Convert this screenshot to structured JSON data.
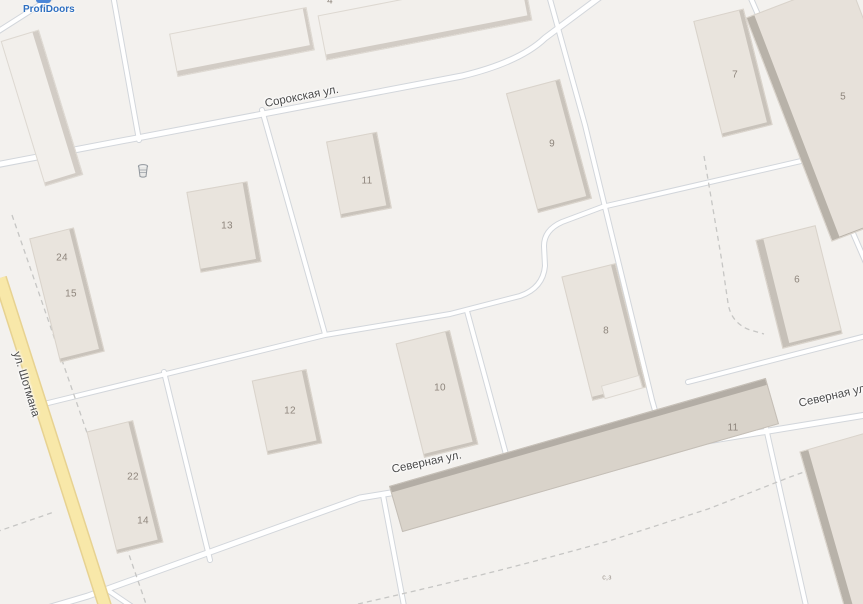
{
  "poi": {
    "profidoors_label": "ProfiDoors",
    "profidoors_color": "#2e6fc0",
    "trash_icon": "trash-bin-icon"
  },
  "streets": {
    "sorokskaya": "Сорокская ул.",
    "shotmana": "ул. Шотмана",
    "severnaya": "Северная ул.",
    "severnaya_east": "Северная ул."
  },
  "building_numbers": {
    "b13": "13",
    "b24": "24",
    "b15": "15",
    "b11_top": "11",
    "b9": "9",
    "b7": "7",
    "b5": "5",
    "b8": "8",
    "b6": "6",
    "b10": "10",
    "b12": "12",
    "b22": "22",
    "b14": "14",
    "b11_south": "11",
    "b4_partial": "4",
    "small_structure": "с,з"
  },
  "colors": {
    "background": "#f3f1ee",
    "road_fill": "#ffffff",
    "road_casing": "#d2d6db",
    "highlighted_road_fill": "#f8e8a9",
    "highlighted_road_casing": "#e7d291",
    "building_fill": "#e9e4dd",
    "building_shadow": "#c9c3bb",
    "street_label": "#4a4a4a",
    "building_number": "#8e857c"
  }
}
